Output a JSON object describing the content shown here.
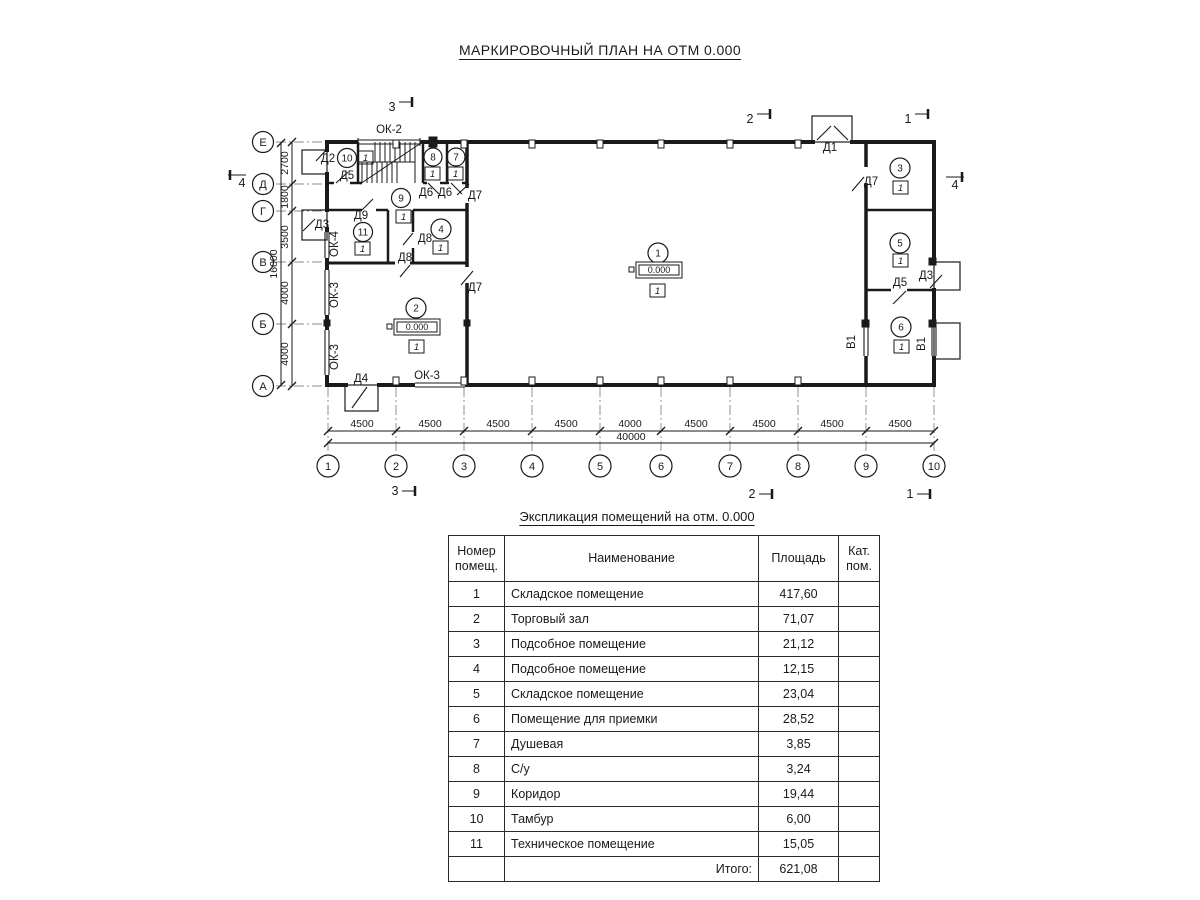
{
  "page": {
    "title": "МАРКИРОВОЧНЫЙ ПЛАН НА ОТМ 0.000"
  },
  "plan": {
    "grid_rows": [
      "Е",
      "Д",
      "Г",
      "В",
      "Б",
      "А"
    ],
    "grid_cols": [
      "1",
      "2",
      "3",
      "4",
      "5",
      "6",
      "7",
      "8",
      "9",
      "10"
    ],
    "dims_bottom": [
      "4500",
      "4500",
      "4500",
      "4500",
      "4000",
      "4500",
      "4500",
      "4500",
      "4500"
    ],
    "dim_total_width": "40000",
    "dims_left": [
      "2700",
      "1800",
      "3500",
      "4000",
      "4000"
    ],
    "dim_total_height": "16000",
    "sections": {
      "s1": "1",
      "s2": "2",
      "s3": "3",
      "s4": "4"
    },
    "rooms": {
      "r1": {
        "num": "1",
        "badge": "1",
        "elev": "0.000"
      },
      "r2": {
        "num": "2",
        "badge": "1",
        "elev": "0.000"
      },
      "r3": {
        "num": "3",
        "badge": "1"
      },
      "r4": {
        "num": "4",
        "badge": "1"
      },
      "r5": {
        "num": "5",
        "badge": "1"
      },
      "r6": {
        "num": "6",
        "badge": "1"
      },
      "r7": {
        "num": "7",
        "badge": "1"
      },
      "r8": {
        "num": "8",
        "badge": "1"
      },
      "r9": {
        "num": "9",
        "badge": "1"
      },
      "r10": {
        "num": "10",
        "badge": "1"
      },
      "r11": {
        "num": "11",
        "badge": "1"
      }
    },
    "labels": {
      "d1": "Д1",
      "d2": "Д2",
      "d3_left": "Д3",
      "d3_right": "Д3",
      "d4": "Д4",
      "d5_tambour": "Д5",
      "d5_right": "Д5",
      "d6_a": "Д6",
      "d6_b": "Д6",
      "d7_corridor": "Д7",
      "d7_hall": "Д7",
      "d7_room3": "Д7",
      "d8_a": "Д8",
      "d8_b": "Д8",
      "d9": "Д9",
      "ok2": "ОК-2",
      "ok3_a": "ОК-3",
      "ok3_b": "ОК-3",
      "ok3_c": "ОК-3",
      "ok4": "ОК-4",
      "v1_left": "В1",
      "v1_right": "В1"
    }
  },
  "table": {
    "title": "Экспликация помещений на отм. 0.000",
    "headers": {
      "num1": "Номер",
      "num2": "помещ.",
      "name": "Наименование",
      "area": "Площадь",
      "cat1": "Кат.",
      "cat2": "пом."
    },
    "rows": [
      {
        "num": "1",
        "name": "Складское помещение",
        "area": "417,60",
        "cat": ""
      },
      {
        "num": "2",
        "name": "Торговый зал",
        "area": "71,07",
        "cat": ""
      },
      {
        "num": "3",
        "name": "Подсобное помещение",
        "area": "21,12",
        "cat": ""
      },
      {
        "num": "4",
        "name": "Подсобное помещение",
        "area": "12,15",
        "cat": ""
      },
      {
        "num": "5",
        "name": "Складское помещение",
        "area": "23,04",
        "cat": ""
      },
      {
        "num": "6",
        "name": "Помещение для приемки",
        "area": "28,52",
        "cat": ""
      },
      {
        "num": "7",
        "name": "Душевая",
        "area": "3,85",
        "cat": ""
      },
      {
        "num": "8",
        "name": "С/у",
        "area": "3,24",
        "cat": ""
      },
      {
        "num": "9",
        "name": "Коридор",
        "area": "19,44",
        "cat": ""
      },
      {
        "num": "10",
        "name": "Тамбур",
        "area": "6,00",
        "cat": ""
      },
      {
        "num": "11",
        "name": "Техническое помещение",
        "area": "15,05",
        "cat": ""
      }
    ],
    "total_label": "Итого:",
    "total_value": "621,08"
  }
}
